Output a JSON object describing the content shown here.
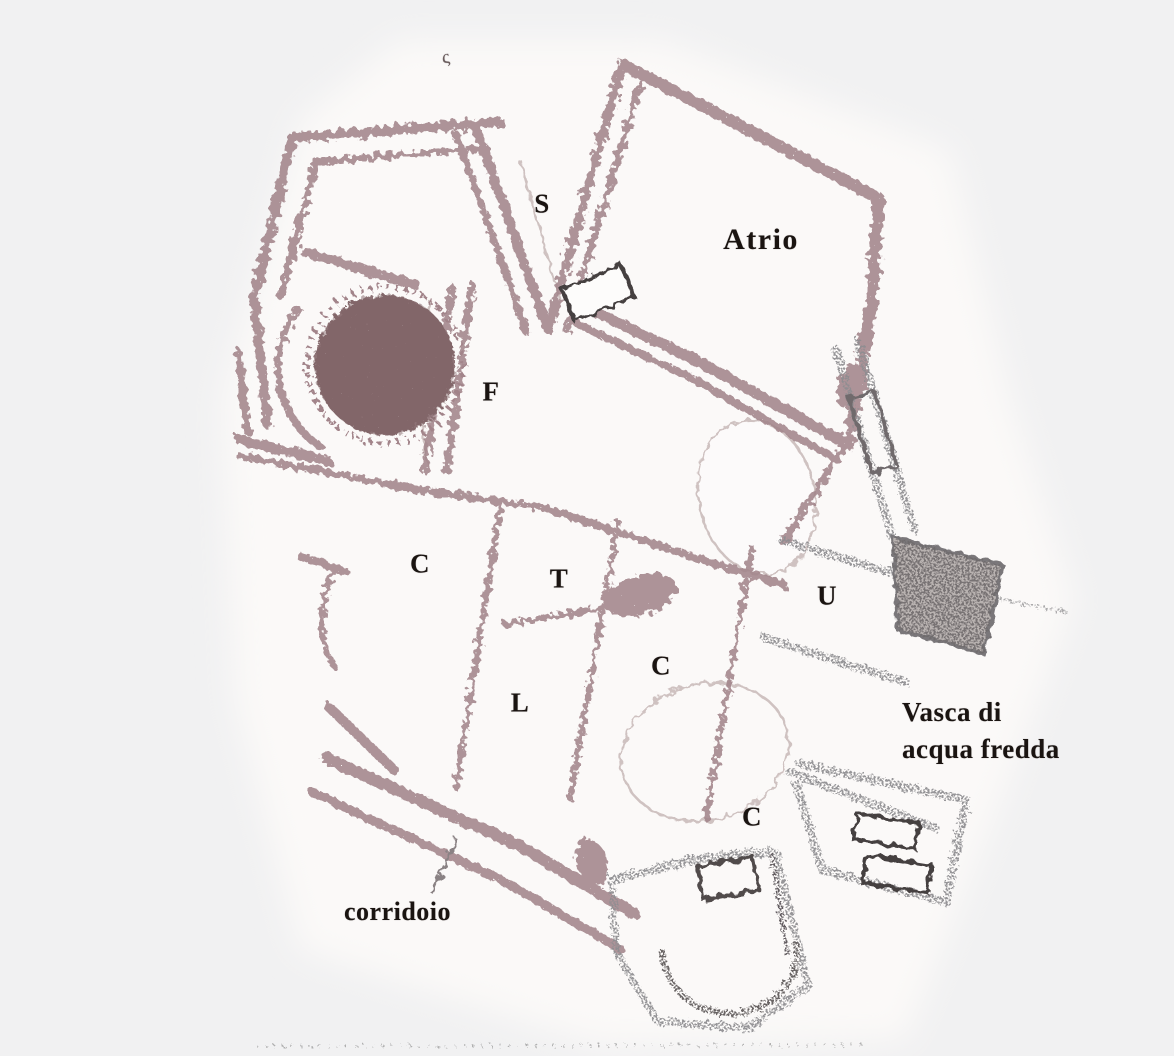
{
  "figure": {
    "kind": "scanned archaeological floor plan of a bath complex",
    "canvas": {
      "width": 1174,
      "height": 1056
    },
    "colors": {
      "page_background": "#f1f1f2",
      "paper": "#fbf9f8",
      "wall_mauve": "#a2848a",
      "wall_gray": "#8e8d90",
      "dark_detail": "#453f40",
      "furnace_circle_fill": "#8d7274",
      "cold_pool_hatch": "#6e696b",
      "label_ink": "#1a1411"
    },
    "labels": {
      "stray_mark": "ς",
      "room_s": "S",
      "atrio": "Atrio",
      "room_f": "F",
      "room_c_upper": "C",
      "room_t": "T",
      "room_u": "U",
      "room_c_middle": "C",
      "room_l": "L",
      "room_c_lower": "C",
      "corridor": "corridoio",
      "cold_pool_line1": "Vasca di",
      "cold_pool_line2": "acqua fredda"
    }
  }
}
